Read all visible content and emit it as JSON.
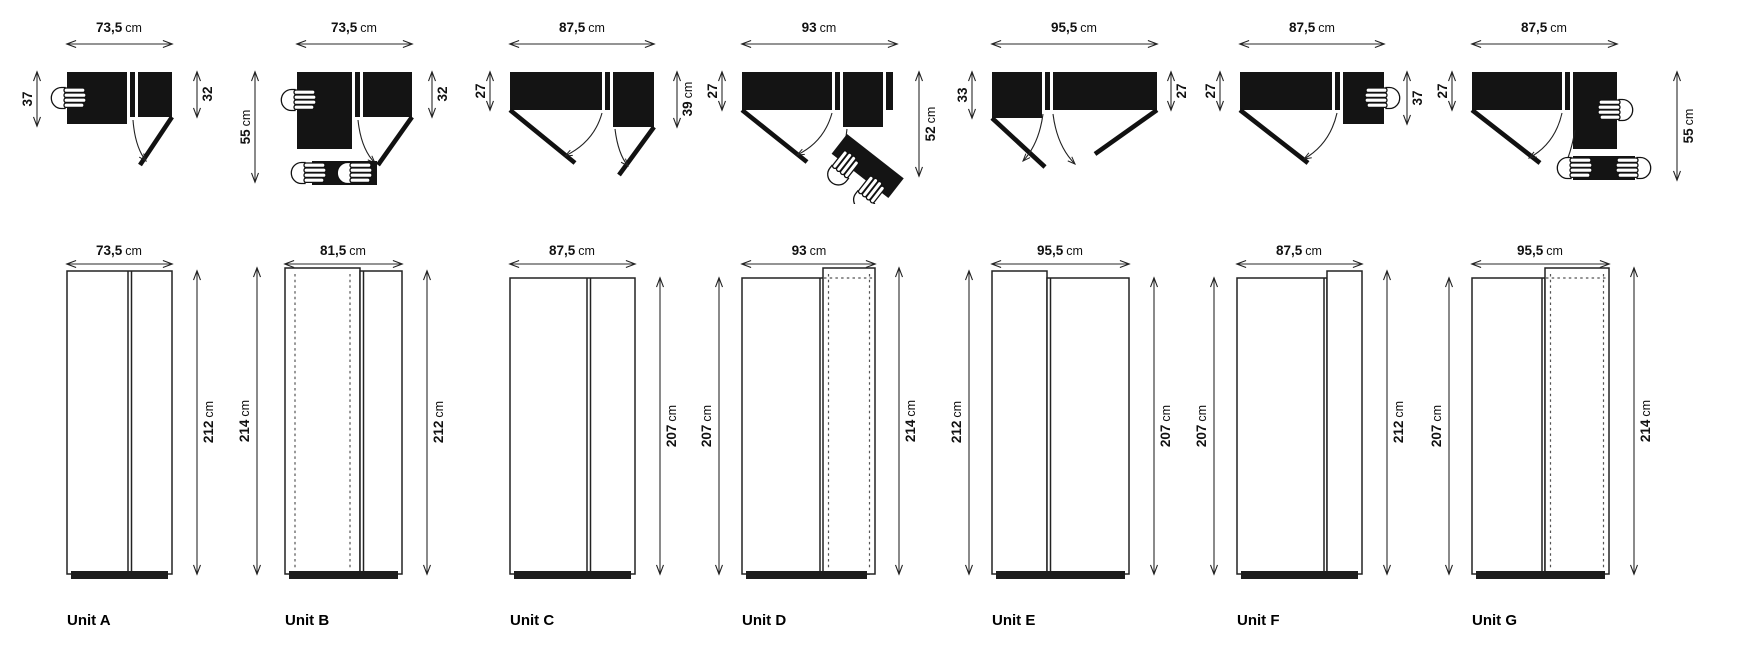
{
  "page": {
    "background": "#ffffff",
    "ink": "#141414"
  },
  "icons": {
    "hand_grip": "hand-icon",
    "door_swing_arrow": "door-swing-arc-icon",
    "dimension_arrow": "dimension-arrow-icon"
  },
  "units": [
    {
      "label": "Unit A",
      "plan": {
        "width": {
          "v": "73,5",
          "u": "cm"
        },
        "left": {
          "v": "37",
          "u": ""
        },
        "right": {
          "v": "32",
          "u": ""
        }
      },
      "elevation": {
        "width": {
          "v": "73,5",
          "u": "cm"
        },
        "right_height": {
          "v": "212",
          "u": "cm"
        }
      }
    },
    {
      "label": "Unit B",
      "plan": {
        "width": {
          "v": "73,5",
          "u": "cm"
        },
        "left": {
          "v": "55",
          "u": "cm"
        },
        "right": {
          "v": "32",
          "u": ""
        }
      },
      "elevation": {
        "width": {
          "v": "81,5",
          "u": "cm"
        },
        "left_height": {
          "v": "214",
          "u": "cm"
        },
        "right_height": {
          "v": "212",
          "u": "cm"
        }
      }
    },
    {
      "label": "Unit C",
      "plan": {
        "width": {
          "v": "87,5",
          "u": "cm"
        },
        "left": {
          "v": "27",
          "u": ""
        },
        "right": {
          "v": "39",
          "u": "cm"
        }
      },
      "elevation": {
        "width": {
          "v": "87,5",
          "u": "cm"
        },
        "right_height": {
          "v": "207",
          "u": "cm"
        }
      }
    },
    {
      "label": "Unit D",
      "plan": {
        "width": {
          "v": "93",
          "u": "cm"
        },
        "left": {
          "v": "27",
          "u": ""
        },
        "right": {
          "v": "52",
          "u": "cm"
        }
      },
      "elevation": {
        "width": {
          "v": "93",
          "u": "cm"
        },
        "left_height": {
          "v": "207",
          "u": "cm"
        },
        "right_height": {
          "v": "214",
          "u": "cm"
        }
      }
    },
    {
      "label": "Unit E",
      "plan": {
        "width": {
          "v": "95,5",
          "u": "cm"
        },
        "left": {
          "v": "33",
          "u": ""
        },
        "right": {
          "v": "27",
          "u": ""
        }
      },
      "elevation": {
        "width": {
          "v": "95,5",
          "u": "cm"
        },
        "left_height": {
          "v": "212",
          "u": "cm"
        },
        "right_height": {
          "v": "207",
          "u": "cm"
        }
      }
    },
    {
      "label": "Unit F",
      "plan": {
        "width": {
          "v": "87,5",
          "u": "cm"
        },
        "left": {
          "v": "27",
          "u": ""
        },
        "right": {
          "v": "37",
          "u": ""
        }
      },
      "elevation": {
        "width": {
          "v": "87,5",
          "u": "cm"
        },
        "left_height": {
          "v": "207",
          "u": "cm"
        },
        "right_height": {
          "v": "212",
          "u": "cm"
        }
      }
    },
    {
      "label": "Unit G",
      "plan": {
        "width": {
          "v": "87,5",
          "u": "cm"
        },
        "left": {
          "v": "27",
          "u": ""
        },
        "right": {
          "v": "55",
          "u": "cm"
        }
      },
      "elevation": {
        "width": {
          "v": "95,5",
          "u": "cm"
        },
        "left_height": {
          "v": "207",
          "u": "cm"
        },
        "right_height": {
          "v": "214",
          "u": "cm"
        }
      }
    }
  ]
}
